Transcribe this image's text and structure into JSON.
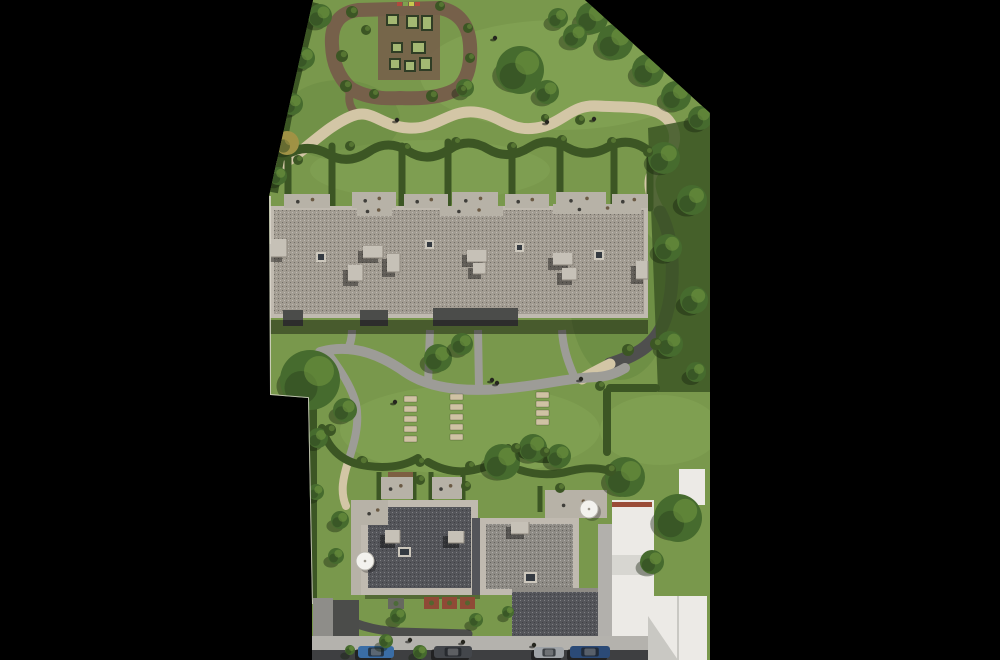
{
  "scene": {
    "kind": "aerial-site-plan-rendering",
    "width": 1000,
    "height": 660
  },
  "palette": {
    "black": "#000000",
    "lawn": "#79984c",
    "lawn_light": "#8fae5e",
    "lawn_dark": "#5d7d38",
    "hedge": "#3c5624",
    "tree": "#466b2e",
    "tree_dark": "#2c441d",
    "tree_light": "#6f9440",
    "tree_shadow": "#14200c",
    "path_beige": "#d3c6a6",
    "mulch": "#76604a",
    "path_gray": "#9d9c97",
    "asphalt": "#4f4f4e",
    "street": "#3e3f41",
    "sidewalk": "#b4b2ad",
    "roof1": "#a29c92",
    "roof1_parapet": "#c0bab0",
    "roof_dark": "#54555a",
    "roof_mid": "#8e8b85",
    "wing": "#b2b0ac",
    "white_bldg": "#eceae6",
    "white_shadow": "#c9c8c3",
    "terracotta": "#9a4c37",
    "skylight": "#343a41",
    "skylight_frame": "#ccc7bc",
    "unit_box": "#c6c1b7",
    "patio": "#b7b2a7",
    "stone": "#cfc2a3",
    "person": "#26261f",
    "parasol": "#f3f2ee",
    "planter_frame": "#303d25",
    "planter_fill": "#a4b873",
    "paver": "#4c4d4b",
    "drive_light": "#8e8d89",
    "drive_dark": "#4b4c4a",
    "wall_white": "#ddd9d0"
  },
  "layers": {
    "lawn_patches": {
      "type": "patch",
      "item": "lawn-shade-patch",
      "items": [
        {
          "x": 560,
          "y": 75,
          "rx": 140,
          "ry": 55,
          "c": "light",
          "o": 0.35
        },
        {
          "x": 430,
          "y": 170,
          "rx": 120,
          "ry": 30,
          "c": "light",
          "o": 0.25
        },
        {
          "x": 470,
          "y": 430,
          "rx": 130,
          "ry": 45,
          "c": "light",
          "o": 0.3
        },
        {
          "x": 660,
          "y": 430,
          "rx": 60,
          "ry": 35,
          "c": "light",
          "o": 0.3
        },
        {
          "x": 620,
          "y": 300,
          "rx": 50,
          "ry": 80,
          "c": "dark",
          "o": 0.35
        },
        {
          "x": 340,
          "y": 120,
          "rx": 60,
          "ry": 40,
          "c": "dark",
          "o": 0.25
        }
      ]
    },
    "planters": {
      "type": "planter",
      "item": "raised-garden-bed",
      "items": [
        {
          "x": 386,
          "y": 14,
          "w": 13,
          "h": 12
        },
        {
          "x": 406,
          "y": 15,
          "w": 13,
          "h": 14
        },
        {
          "x": 421,
          "y": 15,
          "w": 12,
          "h": 16
        },
        {
          "x": 391,
          "y": 42,
          "w": 12,
          "h": 11
        },
        {
          "x": 411,
          "y": 41,
          "w": 15,
          "h": 13
        },
        {
          "x": 389,
          "y": 58,
          "w": 12,
          "h": 12
        },
        {
          "x": 404,
          "y": 60,
          "w": 12,
          "h": 12
        },
        {
          "x": 419,
          "y": 57,
          "w": 13,
          "h": 14
        }
      ]
    },
    "flowers": {
      "type": "flower",
      "item": "flower-strip",
      "items": [
        {
          "x": 397,
          "y": 2,
          "w": 5,
          "h": 4,
          "c": "#b04a3e"
        },
        {
          "x": 403,
          "y": 2,
          "w": 5,
          "h": 4,
          "c": "#7fa04f"
        },
        {
          "x": 409,
          "y": 2,
          "w": 5,
          "h": 4,
          "c": "#c8c84f"
        },
        {
          "x": 415,
          "y": 2,
          "w": 5,
          "h": 4,
          "c": "#b04a3e"
        }
      ]
    },
    "stones": {
      "type": "stone",
      "item": "stepping-stone",
      "items": [
        {
          "x": 404,
          "y": 396,
          "w": 13,
          "h": 6
        },
        {
          "x": 404,
          "y": 406,
          "w": 13,
          "h": 6
        },
        {
          "x": 404,
          "y": 416,
          "w": 13,
          "h": 6
        },
        {
          "x": 404,
          "y": 426,
          "w": 13,
          "h": 6
        },
        {
          "x": 404,
          "y": 436,
          "w": 13,
          "h": 6
        },
        {
          "x": 450,
          "y": 394,
          "w": 13,
          "h": 6
        },
        {
          "x": 450,
          "y": 404,
          "w": 13,
          "h": 6
        },
        {
          "x": 450,
          "y": 414,
          "w": 13,
          "h": 6
        },
        {
          "x": 450,
          "y": 424,
          "w": 13,
          "h": 6
        },
        {
          "x": 450,
          "y": 434,
          "w": 13,
          "h": 6
        },
        {
          "x": 536,
          "y": 392,
          "w": 13,
          "h": 6
        },
        {
          "x": 536,
          "y": 401,
          "w": 13,
          "h": 6
        },
        {
          "x": 536,
          "y": 410,
          "w": 13,
          "h": 6
        },
        {
          "x": 536,
          "y": 419,
          "w": 13,
          "h": 6
        }
      ]
    },
    "patios": {
      "type": "patio",
      "item": "terrace-patio",
      "items": [
        {
          "x": 284,
          "y": 194,
          "w": 46,
          "h": 14
        },
        {
          "x": 352,
          "y": 192,
          "w": 44,
          "h": 16
        },
        {
          "x": 404,
          "y": 194,
          "w": 44,
          "h": 14
        },
        {
          "x": 452,
          "y": 192,
          "w": 46,
          "h": 16
        },
        {
          "x": 505,
          "y": 194,
          "w": 44,
          "h": 14
        },
        {
          "x": 556,
          "y": 192,
          "w": 50,
          "h": 16
        },
        {
          "x": 612,
          "y": 194,
          "w": 36,
          "h": 14
        },
        {
          "x": 357,
          "y": 206,
          "w": 35,
          "h": 10
        },
        {
          "x": 440,
          "y": 206,
          "w": 63,
          "h": 10
        },
        {
          "x": 553,
          "y": 204,
          "w": 88,
          "h": 10
        },
        {
          "x": 361,
          "y": 500,
          "w": 27,
          "h": 25
        },
        {
          "x": 381,
          "y": 477,
          "w": 32,
          "h": 22
        },
        {
          "x": 432,
          "y": 477,
          "w": 30,
          "h": 22
        },
        {
          "x": 545,
          "y": 490,
          "w": 62,
          "h": 28
        }
      ]
    },
    "skylights": {
      "type": "skylight",
      "item": "roof-skylight",
      "items": [
        {
          "x": 316,
          "y": 252,
          "w": 10,
          "h": 10
        },
        {
          "x": 425,
          "y": 240,
          "w": 9,
          "h": 9
        },
        {
          "x": 515,
          "y": 243,
          "w": 9,
          "h": 9
        },
        {
          "x": 594,
          "y": 250,
          "w": 10,
          "h": 10
        },
        {
          "x": 398,
          "y": 547,
          "w": 13,
          "h": 10
        },
        {
          "x": 524,
          "y": 572,
          "w": 13,
          "h": 11
        }
      ]
    },
    "units": {
      "type": "unit",
      "item": "rooftop-unit",
      "items": [
        {
          "x": 271,
          "y": 239,
          "w": 16,
          "h": 18
        },
        {
          "x": 363,
          "y": 246,
          "w": 20,
          "h": 12
        },
        {
          "x": 387,
          "y": 254,
          "w": 13,
          "h": 18
        },
        {
          "x": 348,
          "y": 265,
          "w": 15,
          "h": 16
        },
        {
          "x": 467,
          "y": 250,
          "w": 20,
          "h": 12
        },
        {
          "x": 473,
          "y": 263,
          "w": 13,
          "h": 11
        },
        {
          "x": 553,
          "y": 253,
          "w": 20,
          "h": 12
        },
        {
          "x": 562,
          "y": 268,
          "w": 15,
          "h": 12
        },
        {
          "x": 636,
          "y": 261,
          "w": 12,
          "h": 18
        },
        {
          "x": 385,
          "y": 530,
          "w": 15,
          "h": 13
        },
        {
          "x": 448,
          "y": 531,
          "w": 16,
          "h": 12
        },
        {
          "x": 511,
          "y": 522,
          "w": 18,
          "h": 12
        }
      ]
    },
    "balcony_planters": {
      "type": "bp",
      "item": "balcony-planter",
      "items": [
        {
          "x": 424,
          "y": 597,
          "w": 15,
          "h": 12,
          "c": "#8f4a36"
        },
        {
          "x": 442,
          "y": 597,
          "w": 15,
          "h": 12,
          "c": "#8f4a36"
        },
        {
          "x": 460,
          "y": 597,
          "w": 15,
          "h": 12,
          "c": "#8f4a36"
        },
        {
          "x": 388,
          "y": 598,
          "w": 16,
          "h": 11,
          "c": "#66685f"
        }
      ]
    },
    "parasols": {
      "type": "parasol",
      "item": "white-parasol",
      "items": [
        {
          "x": 365,
          "y": 561,
          "r": 9
        },
        {
          "x": 589,
          "y": 509,
          "r": 9
        }
      ]
    },
    "cars": {
      "type": "car",
      "item": "parked-car",
      "items": [
        {
          "x": 358,
          "y": 646,
          "w": 36,
          "h": 12,
          "c": "#3a6da6"
        },
        {
          "x": 434,
          "y": 646,
          "w": 38,
          "h": 12,
          "c": "#43464b"
        },
        {
          "x": 534,
          "y": 647,
          "w": 30,
          "h": 11,
          "c": "#9fa3a7"
        },
        {
          "x": 570,
          "y": 646,
          "w": 40,
          "h": 12,
          "c": "#2b4a77"
        }
      ]
    },
    "trees": {
      "type": "tree",
      "item": "tree",
      "items": [
        {
          "x": 592,
          "y": 18,
          "r": 16
        },
        {
          "x": 615,
          "y": 42,
          "r": 18
        },
        {
          "x": 648,
          "y": 70,
          "r": 16
        },
        {
          "x": 676,
          "y": 96,
          "r": 15
        },
        {
          "x": 700,
          "y": 118,
          "r": 12
        },
        {
          "x": 575,
          "y": 36,
          "r": 12
        },
        {
          "x": 558,
          "y": 18,
          "r": 10
        },
        {
          "x": 320,
          "y": 16,
          "r": 12
        },
        {
          "x": 304,
          "y": 58,
          "r": 11
        },
        {
          "x": 292,
          "y": 104,
          "r": 11
        },
        {
          "x": 287,
          "y": 143,
          "r": 12,
          "c": "#a09245"
        },
        {
          "x": 278,
          "y": 176,
          "r": 9
        },
        {
          "x": 520,
          "y": 70,
          "r": 24
        },
        {
          "x": 547,
          "y": 92,
          "r": 12
        },
        {
          "x": 465,
          "y": 88,
          "r": 9
        },
        {
          "x": 664,
          "y": 158,
          "r": 16
        },
        {
          "x": 692,
          "y": 200,
          "r": 15
        },
        {
          "x": 668,
          "y": 248,
          "r": 14
        },
        {
          "x": 694,
          "y": 300,
          "r": 14
        },
        {
          "x": 670,
          "y": 344,
          "r": 13
        },
        {
          "x": 696,
          "y": 372,
          "r": 10
        },
        {
          "x": 310,
          "y": 380,
          "r": 30
        },
        {
          "x": 345,
          "y": 410,
          "r": 12
        },
        {
          "x": 438,
          "y": 358,
          "r": 14
        },
        {
          "x": 462,
          "y": 344,
          "r": 11
        },
        {
          "x": 502,
          "y": 462,
          "r": 18
        },
        {
          "x": 533,
          "y": 448,
          "r": 14
        },
        {
          "x": 559,
          "y": 456,
          "r": 12
        },
        {
          "x": 625,
          "y": 477,
          "r": 20
        },
        {
          "x": 678,
          "y": 518,
          "r": 24
        },
        {
          "x": 652,
          "y": 562,
          "r": 12
        },
        {
          "x": 340,
          "y": 520,
          "r": 9
        },
        {
          "x": 336,
          "y": 556,
          "r": 8
        },
        {
          "x": 318,
          "y": 438,
          "r": 10
        },
        {
          "x": 316,
          "y": 492,
          "r": 8
        },
        {
          "x": 386,
          "y": 641,
          "r": 7
        },
        {
          "x": 420,
          "y": 652,
          "r": 7
        },
        {
          "x": 350,
          "y": 650,
          "r": 5
        },
        {
          "x": 476,
          "y": 620,
          "r": 7
        },
        {
          "x": 398,
          "y": 616,
          "r": 8
        },
        {
          "x": 508,
          "y": 612,
          "r": 6
        }
      ]
    },
    "bushes": {
      "type": "bush",
      "item": "shrub",
      "items": [
        {
          "x": 352,
          "y": 12,
          "r": 6
        },
        {
          "x": 366,
          "y": 30,
          "r": 5
        },
        {
          "x": 342,
          "y": 56,
          "r": 6
        },
        {
          "x": 346,
          "y": 86,
          "r": 6
        },
        {
          "x": 374,
          "y": 94,
          "r": 5
        },
        {
          "x": 432,
          "y": 96,
          "r": 6
        },
        {
          "x": 462,
          "y": 90,
          "r": 5
        },
        {
          "x": 470,
          "y": 58,
          "r": 5
        },
        {
          "x": 468,
          "y": 28,
          "r": 5
        },
        {
          "x": 440,
          "y": 6,
          "r": 5
        },
        {
          "x": 298,
          "y": 160,
          "r": 5
        },
        {
          "x": 350,
          "y": 146,
          "r": 5
        },
        {
          "x": 406,
          "y": 148,
          "r": 5
        },
        {
          "x": 456,
          "y": 142,
          "r": 5
        },
        {
          "x": 512,
          "y": 147,
          "r": 5
        },
        {
          "x": 562,
          "y": 140,
          "r": 5
        },
        {
          "x": 612,
          "y": 142,
          "r": 5
        },
        {
          "x": 648,
          "y": 152,
          "r": 5
        },
        {
          "x": 330,
          "y": 430,
          "r": 6
        },
        {
          "x": 362,
          "y": 462,
          "r": 6
        },
        {
          "x": 420,
          "y": 462,
          "r": 5
        },
        {
          "x": 470,
          "y": 466,
          "r": 5
        },
        {
          "x": 516,
          "y": 448,
          "r": 5
        },
        {
          "x": 545,
          "y": 452,
          "r": 5
        },
        {
          "x": 628,
          "y": 350,
          "r": 6
        },
        {
          "x": 600,
          "y": 386,
          "r": 5
        },
        {
          "x": 656,
          "y": 344,
          "r": 6
        },
        {
          "x": 420,
          "y": 480,
          "r": 5
        },
        {
          "x": 466,
          "y": 486,
          "r": 5
        },
        {
          "x": 610,
          "y": 470,
          "r": 6
        },
        {
          "x": 560,
          "y": 488,
          "r": 5
        },
        {
          "x": 580,
          "y": 120,
          "r": 5
        },
        {
          "x": 545,
          "y": 118,
          "r": 4
        }
      ]
    },
    "people": {
      "type": "person",
      "item": "pedestrian",
      "items": [
        {
          "x": 397,
          "y": 120
        },
        {
          "x": 547,
          "y": 122
        },
        {
          "x": 594,
          "y": 119
        },
        {
          "x": 492,
          "y": 380
        },
        {
          "x": 497,
          "y": 383
        },
        {
          "x": 581,
          "y": 379
        },
        {
          "x": 395,
          "y": 402
        },
        {
          "x": 410,
          "y": 640
        },
        {
          "x": 463,
          "y": 642
        },
        {
          "x": 534,
          "y": 645
        },
        {
          "x": 495,
          "y": 38
        }
      ]
    }
  }
}
